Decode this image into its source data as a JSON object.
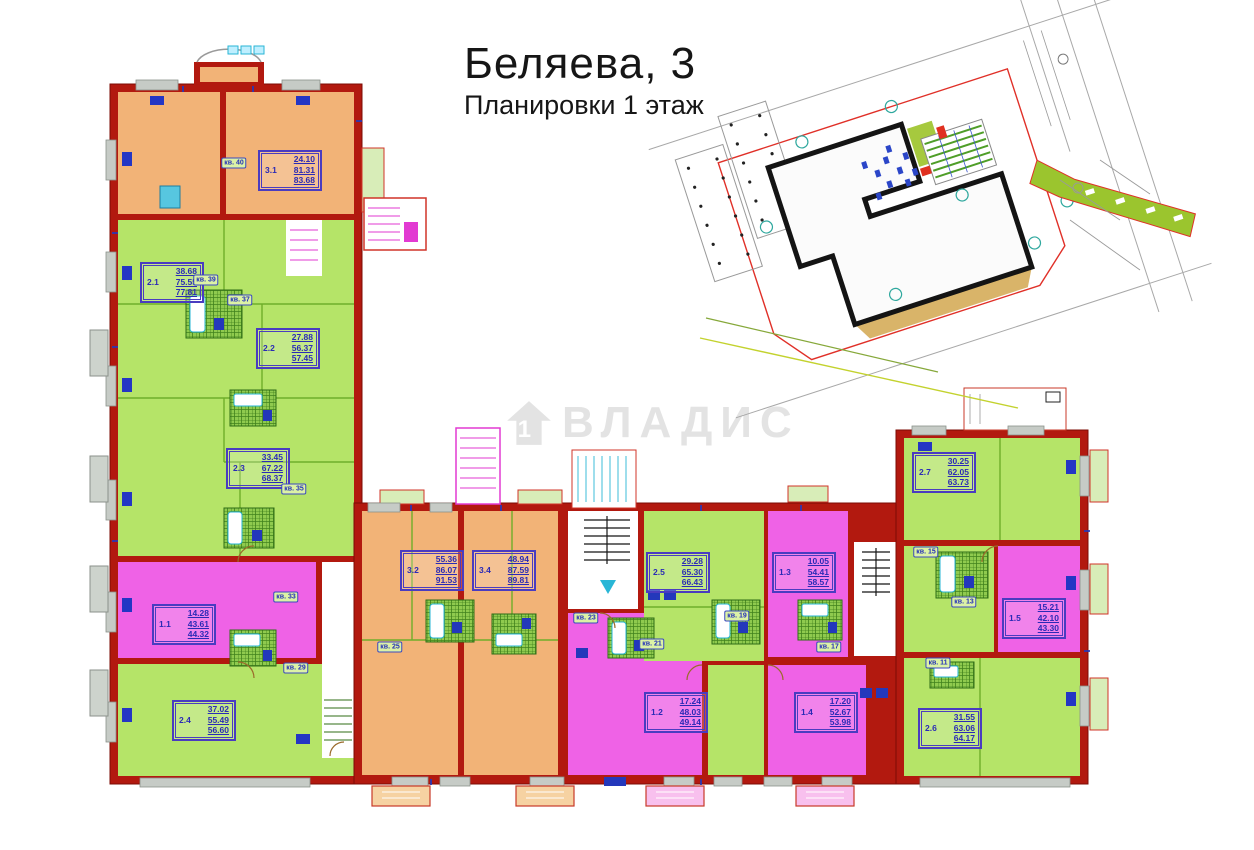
{
  "header": {
    "title": "Беляева, 3",
    "subtitle": "Планировки 1 этаж"
  },
  "watermark": {
    "text": "ВЛАДИС",
    "icon": "house-number-1-icon"
  },
  "palette": {
    "wall_red": "#b2190f",
    "room_orange": "#f2b377",
    "room_green": "#b5e468",
    "room_magenta": "#ef62e6",
    "balcony_gray": "#cdd3cc",
    "balcony_green": "#d8edb8",
    "label_blue": "#2a2ab6",
    "fixture_cyan": "#29b6d6",
    "fixture_blue": "#2338bb",
    "site_boundary_red": "#e03028",
    "path_green": "#9bc52e"
  },
  "apartments": [
    {
      "no": "3.1",
      "a1": "24.10",
      "a2": "81.31",
      "a3": "83.68",
      "x": 258,
      "y": 150
    },
    {
      "no": "2.1",
      "a1": "38.68",
      "a2": "75.55",
      "a3": "77.81",
      "x": 140,
      "y": 262
    },
    {
      "no": "2.2",
      "a1": "27.88",
      "a2": "56.37",
      "a3": "57.45",
      "x": 256,
      "y": 328
    },
    {
      "no": "2.3",
      "a1": "33.45",
      "a2": "67.22",
      "a3": "68.37",
      "x": 226,
      "y": 448
    },
    {
      "no": "1.1",
      "a1": "14.28",
      "a2": "43.61",
      "a3": "44.32",
      "x": 152,
      "y": 604
    },
    {
      "no": "2.4",
      "a1": "37.02",
      "a2": "55.49",
      "a3": "56.60",
      "x": 172,
      "y": 700
    },
    {
      "no": "3.2",
      "a1": "55.36",
      "a2": "86.07",
      "a3": "91.53",
      "x": 400,
      "y": 550
    },
    {
      "no": "3.4",
      "a1": "48.94",
      "a2": "87.59",
      "a3": "89.81",
      "x": 472,
      "y": 550
    },
    {
      "no": "2.5",
      "a1": "29.28",
      "a2": "65.30",
      "a3": "66.43",
      "x": 646,
      "y": 552
    },
    {
      "no": "1.3",
      "a1": "10.05",
      "a2": "54.41",
      "a3": "58.57",
      "x": 772,
      "y": 552
    },
    {
      "no": "2.7",
      "a1": "30.25",
      "a2": "62.05",
      "a3": "63.73",
      "x": 912,
      "y": 452
    },
    {
      "no": "1.5",
      "a1": "15.21",
      "a2": "42.10",
      "a3": "43.30",
      "x": 1002,
      "y": 598
    },
    {
      "no": "1.2",
      "a1": "17.24",
      "a2": "48.03",
      "a3": "49.14",
      "x": 644,
      "y": 692
    },
    {
      "no": "1.4",
      "a1": "17.20",
      "a2": "52.67",
      "a3": "53.98",
      "x": 794,
      "y": 692
    },
    {
      "no": "2.6",
      "a1": "31.55",
      "a2": "63.06",
      "a3": "64.17",
      "x": 918,
      "y": 708
    }
  ],
  "badges": [
    {
      "text": "кв. 40",
      "x": 234,
      "y": 163
    },
    {
      "text": "кв. 39",
      "x": 206,
      "y": 280
    },
    {
      "text": "кв. 37",
      "x": 240,
      "y": 300
    },
    {
      "text": "кв. 35",
      "x": 294,
      "y": 489
    },
    {
      "text": "кв. 33",
      "x": 286,
      "y": 597
    },
    {
      "text": "кв. 29",
      "x": 296,
      "y": 668
    },
    {
      "text": "кв. 25",
      "x": 390,
      "y": 647
    },
    {
      "text": "кв. 23",
      "x": 586,
      "y": 618
    },
    {
      "text": "кв. 21",
      "x": 652,
      "y": 644
    },
    {
      "text": "кв. 19",
      "x": 737,
      "y": 616
    },
    {
      "text": "кв. 17",
      "x": 829,
      "y": 647
    },
    {
      "text": "кв. 15",
      "x": 926,
      "y": 552
    },
    {
      "text": "кв. 13",
      "x": 964,
      "y": 602
    },
    {
      "text": "кв. 11",
      "x": 938,
      "y": 663
    }
  ]
}
